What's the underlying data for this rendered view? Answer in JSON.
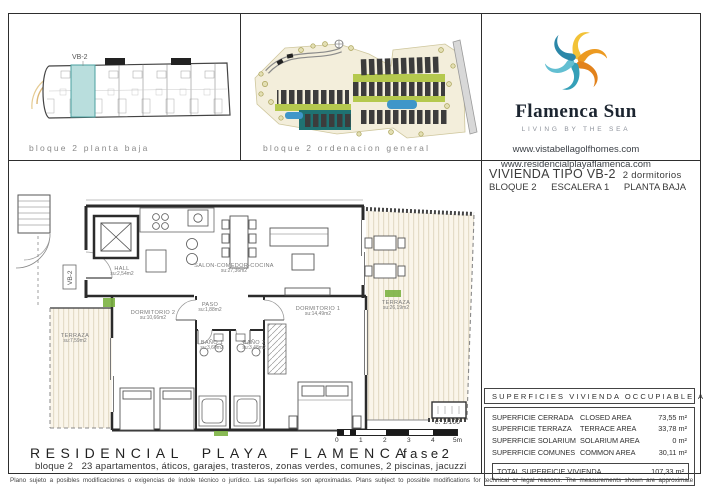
{
  "panels": {
    "block_plan": {
      "caption": "bloque 2 planta baja",
      "unit_tag": "VB-2"
    },
    "site_plan": {
      "caption": "bloque 2 ordenacion general"
    },
    "brand": {
      "name": "Flamenca Sun",
      "tagline": "LIVING BY THE SEA",
      "url1": "www.vistabellagolfhomes.com",
      "url2": "www.residencialplayaflamenca.com"
    }
  },
  "unit_header": {
    "title": "VIVIENDA TIPO VB-2",
    "bedrooms": "2 dormitorios",
    "block": "BLOQUE 2",
    "stair": "ESCALERA 1",
    "floor": "PLANTA BAJA"
  },
  "floor_plan": {
    "unit_tag": "VB-2",
    "rooms": [
      {
        "name": "HALL",
        "area": "su:2,54m2"
      },
      {
        "name": "SALON-COMEDOR-COCINA",
        "area": "su:27,36m2"
      },
      {
        "name": "PASO",
        "area": "su:1,88m2"
      },
      {
        "name": "DORMITORIO 2",
        "area": "su:10,66m2"
      },
      {
        "name": "DORMITORIO 1",
        "area": "su:14,49m2"
      },
      {
        "name": "BAÑO 1",
        "area": "su:3,60m2"
      },
      {
        "name": "BAÑO 2",
        "area": "su:3,48m2"
      },
      {
        "name": "TERRAZA",
        "area": "su:7,59m2"
      },
      {
        "name": "TERRAZA",
        "area": "su:26,19m2"
      }
    ],
    "scale_note": "e: 1/100",
    "scale_ticks": [
      "0",
      "1",
      "2",
      "3",
      "4",
      "5m"
    ]
  },
  "areas_table": {
    "header": "SUPERFICIES  VIVIENDA  OCCUPIABLE  AREA",
    "rows": [
      {
        "es": "SUPERFICIE CERRADA",
        "en": "CLOSED AREA",
        "value": "73,55 m²"
      },
      {
        "es": "SUPERFICIE TERRAZA",
        "en": "TERRACE AREA",
        "value": "33,78 m²"
      },
      {
        "es": "SUPERFICIE SOLARIUM",
        "en": "SOLARIUM AREA",
        "value": "0 m²"
      },
      {
        "es": "SUPERFICIE COMUNES",
        "en": "COMMON AREA",
        "value": "30,11 m²"
      }
    ],
    "total_label": "TOTAL SUPERFICIE VIVIENDA",
    "total_value": "107,33 m²"
  },
  "footer": {
    "title": "RESIDENCIAL PLAYA FLAMENCA",
    "phase": "fase2",
    "subtitle": "bloque 2   23 apartamentos, áticos, garajes, trasteros, zonas verdes, comunes, 2 piscinas, jacuzzi",
    "disclaimer": "Plano sujeto a posibles modificaciones o exigencias de índole técnico o jurídico. Las superficies son aproximadas. Plans subject to possible modifications for technical or legal reasons. The measurements shown are approximate"
  },
  "colors": {
    "highlight_unit": "#b9dedd",
    "deck": "#faf5ea",
    "pool": "#3f96c9",
    "lawn": "#b5c94e",
    "accent_green": "#7cb342",
    "logo_orange": "#ec9a21",
    "logo_yellow": "#f2c237",
    "logo_teal": "#35a0b8"
  }
}
